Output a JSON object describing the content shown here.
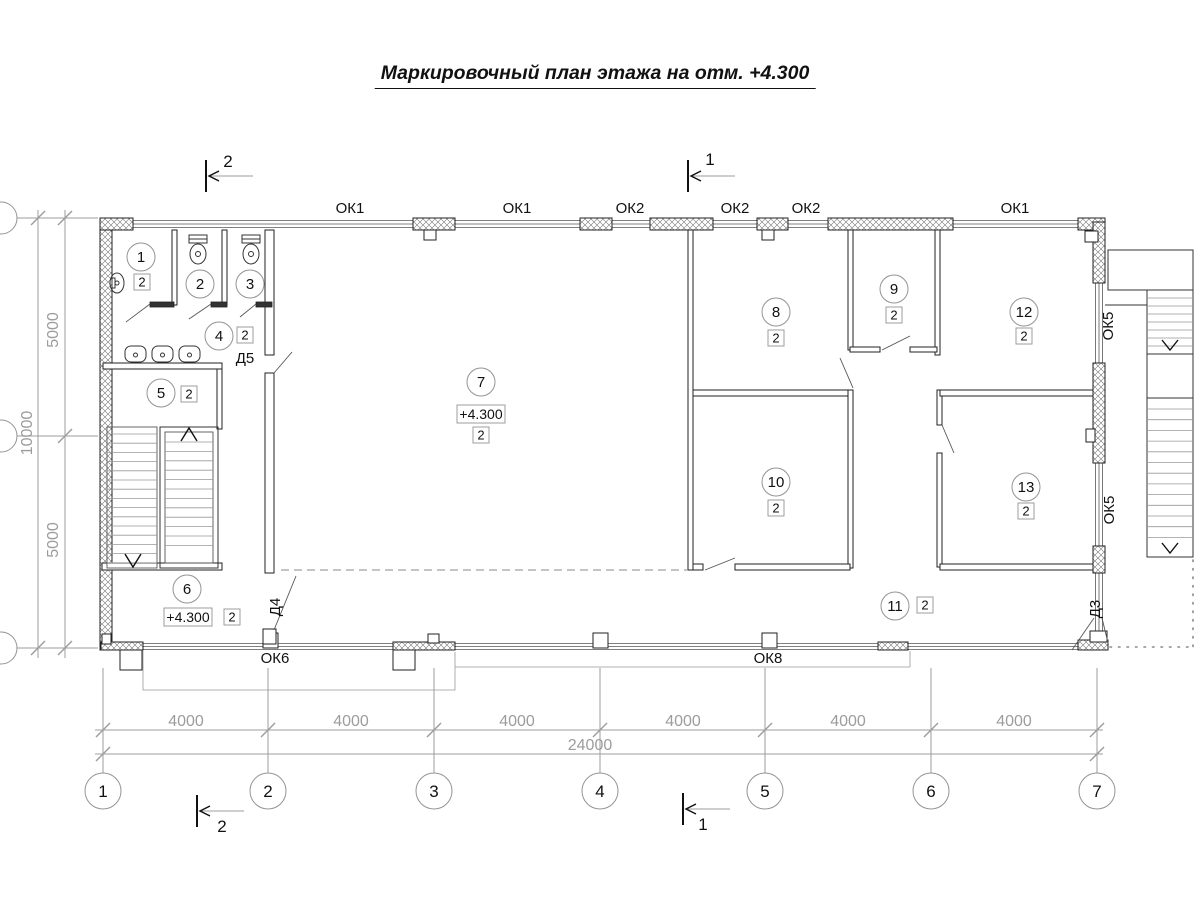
{
  "title": "Маркировочный план этажа на отм. +4.300",
  "colors": {
    "line": "#222222",
    "dim_gray": "#9c9c9c",
    "hatch": "#777777",
    "background": "#ffffff"
  },
  "plan": {
    "room_markers": [
      {
        "n": "1",
        "cx": 141,
        "cy": 257,
        "badge": {
          "t": "2",
          "x": 142,
          "y": 282
        }
      },
      {
        "n": "2",
        "cx": 200,
        "cy": 284
      },
      {
        "n": "3",
        "cx": 250,
        "cy": 284
      },
      {
        "n": "4",
        "cx": 219,
        "cy": 336,
        "badge": {
          "t": "2",
          "x": 245,
          "y": 335
        }
      },
      {
        "n": "5",
        "cx": 161,
        "cy": 393,
        "badge": {
          "t": "2",
          "x": 189,
          "y": 394
        }
      },
      {
        "n": "6",
        "cx": 187,
        "cy": 589,
        "badge": {
          "t": "2",
          "x": 232,
          "y": 617
        },
        "elev": {
          "t": "+4.300",
          "x": 188,
          "y": 617
        }
      },
      {
        "n": "7",
        "cx": 481,
        "cy": 382,
        "badge": {
          "t": "2",
          "x": 481,
          "y": 435
        },
        "elev": {
          "t": "+4.300",
          "x": 481,
          "y": 414
        }
      },
      {
        "n": "8",
        "cx": 776,
        "cy": 312,
        "badge": {
          "t": "2",
          "x": 776,
          "y": 338
        }
      },
      {
        "n": "9",
        "cx": 894,
        "cy": 289,
        "badge": {
          "t": "2",
          "x": 894,
          "y": 315
        }
      },
      {
        "n": "10",
        "cx": 776,
        "cy": 482,
        "badge": {
          "t": "2",
          "x": 776,
          "y": 508
        }
      },
      {
        "n": "11",
        "cx": 895,
        "cy": 606,
        "badge": {
          "t": "2",
          "x": 925,
          "y": 605
        }
      },
      {
        "n": "12",
        "cx": 1024,
        "cy": 312,
        "badge": {
          "t": "2",
          "x": 1024,
          "y": 336
        }
      },
      {
        "n": "13",
        "cx": 1026,
        "cy": 487,
        "badge": {
          "t": "2",
          "x": 1026,
          "y": 511
        }
      }
    ],
    "window_labels": [
      {
        "t": "ОК1",
        "x": 350,
        "y": 208
      },
      {
        "t": "ОК1",
        "x": 517,
        "y": 208
      },
      {
        "t": "ОК2",
        "x": 630,
        "y": 208
      },
      {
        "t": "ОК2",
        "x": 735,
        "y": 208
      },
      {
        "t": "ОК2",
        "x": 806,
        "y": 208
      },
      {
        "t": "ОК1",
        "x": 1015,
        "y": 208
      },
      {
        "t": "ОК5",
        "x": 1113,
        "y": 321,
        "rot": -90
      },
      {
        "t": "ОК5",
        "x": 1114,
        "y": 505,
        "rot": -90
      },
      {
        "t": "ОК6",
        "x": 275,
        "y": 658
      },
      {
        "t": "ОК8",
        "x": 768,
        "y": 658
      }
    ],
    "door_labels": [
      {
        "t": "Д5",
        "x": 245,
        "y": 358
      },
      {
        "t": "Д4",
        "x": 280,
        "y": 602,
        "rot": -90
      },
      {
        "t": "Д3",
        "x": 1100,
        "y": 604,
        "rot": -90
      }
    ]
  },
  "axes": {
    "bottom": [
      {
        "n": "1",
        "x": 103
      },
      {
        "n": "2",
        "x": 268
      },
      {
        "n": "3",
        "x": 434
      },
      {
        "n": "4",
        "x": 600
      },
      {
        "n": "5",
        "x": 765
      },
      {
        "n": "6",
        "x": 931
      },
      {
        "n": "7",
        "x": 1097
      }
    ],
    "left_tick_y": [
      218,
      436,
      648
    ]
  },
  "dims": {
    "bottom_segments": [
      {
        "t": "4000",
        "x": 186
      },
      {
        "t": "4000",
        "x": 351
      },
      {
        "t": "4000",
        "x": 517
      },
      {
        "t": "4000",
        "x": 683
      },
      {
        "t": "4000",
        "x": 848
      },
      {
        "t": "4000",
        "x": 1014
      }
    ],
    "total": {
      "t": "24000",
      "x": 590
    },
    "left": [
      {
        "t": "5000",
        "y": 330
      },
      {
        "t": "10000",
        "y": 433
      },
      {
        "t": "5000",
        "y": 540
      }
    ]
  },
  "sections": [
    {
      "n": "2",
      "bar_x": 206,
      "line_y": 176,
      "num_x": 228,
      "num_y": 167,
      "loc": "top"
    },
    {
      "n": "1",
      "bar_x": 688,
      "line_y": 176,
      "num_x": 710,
      "num_y": 165,
      "loc": "top"
    },
    {
      "n": "2",
      "bar_x": 197,
      "line_y": 811,
      "num_x": 222,
      "num_y": 832,
      "loc": "bottom"
    },
    {
      "n": "1",
      "bar_x": 683,
      "line_y": 809,
      "num_x": 703,
      "num_y": 830,
      "loc": "bottom"
    }
  ]
}
